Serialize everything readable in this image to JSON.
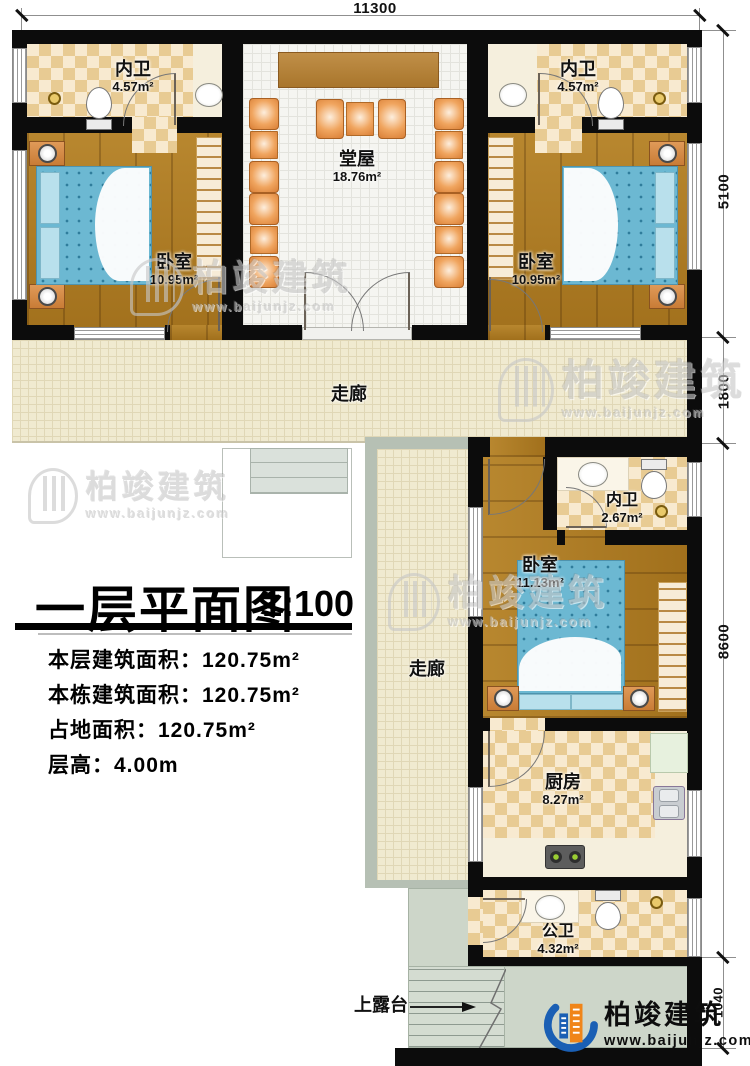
{
  "title_block": {
    "title": "一层平面图",
    "scale": "1:100",
    "info": [
      "本层建筑面积：120.75m²",
      "本栋建筑面积：120.75m²",
      "占地面积：120.75m²",
      "层高：4.00m"
    ]
  },
  "dimensions": {
    "top": "11300",
    "right": [
      "5100",
      "1800",
      "8600",
      "1040"
    ]
  },
  "rooms": {
    "bath_tl": {
      "name": "内卫",
      "area": "4.57m²"
    },
    "bath_tr": {
      "name": "内卫",
      "area": "4.57m²"
    },
    "hall": {
      "name": "堂屋",
      "area": "18.76m²"
    },
    "bed_l": {
      "name": "卧室",
      "area": "10.95m²"
    },
    "bed_r": {
      "name": "卧室",
      "area": "10.95m²"
    },
    "corridor_h": {
      "name": "走廊"
    },
    "corridor_v": {
      "name": "走廊"
    },
    "bath_m": {
      "name": "内卫",
      "area": "2.67m²"
    },
    "bed_m": {
      "name": "卧室",
      "area": "11.13m²"
    },
    "kitchen": {
      "name": "厨房",
      "area": "8.27m²"
    },
    "bath_b": {
      "name": "公卫",
      "area": "4.32m²"
    },
    "terrace": {
      "name": "上露台"
    }
  },
  "brand": {
    "name": "柏竣建筑",
    "url": "www.baijunjz.com"
  },
  "colors": {
    "logo_blue": "#1a5fb4",
    "logo_orange": "#f08519",
    "wall": "#0c0c0c"
  }
}
